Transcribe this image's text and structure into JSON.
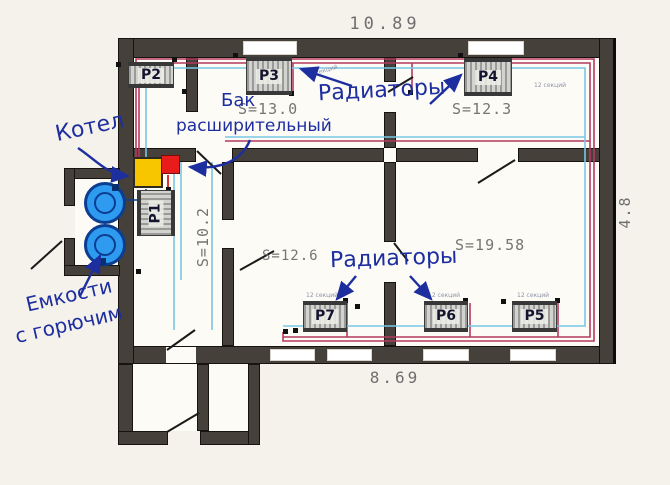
{
  "plan": {
    "dimensions": {
      "top": "10.89",
      "bottom": "8.69",
      "right": "4.8"
    },
    "rooms": {
      "s13": "S=13.0",
      "s123": "S=12.3",
      "s102": "S=10.2",
      "s126": "S=12.6",
      "s1958": "S=19.58"
    },
    "radiators": [
      {
        "id": "P1",
        "label": "P1"
      },
      {
        "id": "P2",
        "label": "P2"
      },
      {
        "id": "P3",
        "label": "P3"
      },
      {
        "id": "P4",
        "label": "P4"
      },
      {
        "id": "P5",
        "label": "P5"
      },
      {
        "id": "P6",
        "label": "P6"
      },
      {
        "id": "P7",
        "label": "P7"
      }
    ],
    "annotations": {
      "boiler": "Котел",
      "expansion_tank_line1": "Бак",
      "expansion_tank_line2": "расширительный",
      "radiators_top": "Радиаторы",
      "radiators_bottom": "Радиаторы",
      "fuel_tanks_line1": "Емкости",
      "fuel_tanks_line2": "с горючим",
      "sections": "12 секций"
    },
    "colors": {
      "wall": "#46403a",
      "pipe_hot": "#b43a5f",
      "pipe_cold": "#79c7e6",
      "annotation_blue": "#1d2e9f",
      "dimension_gray": "#6f6f6f",
      "boiler_yellow": "#f7c600",
      "expansion_tank_red": "#e91c1c",
      "fuel_tank_blue": "#2e9bf0"
    }
  }
}
